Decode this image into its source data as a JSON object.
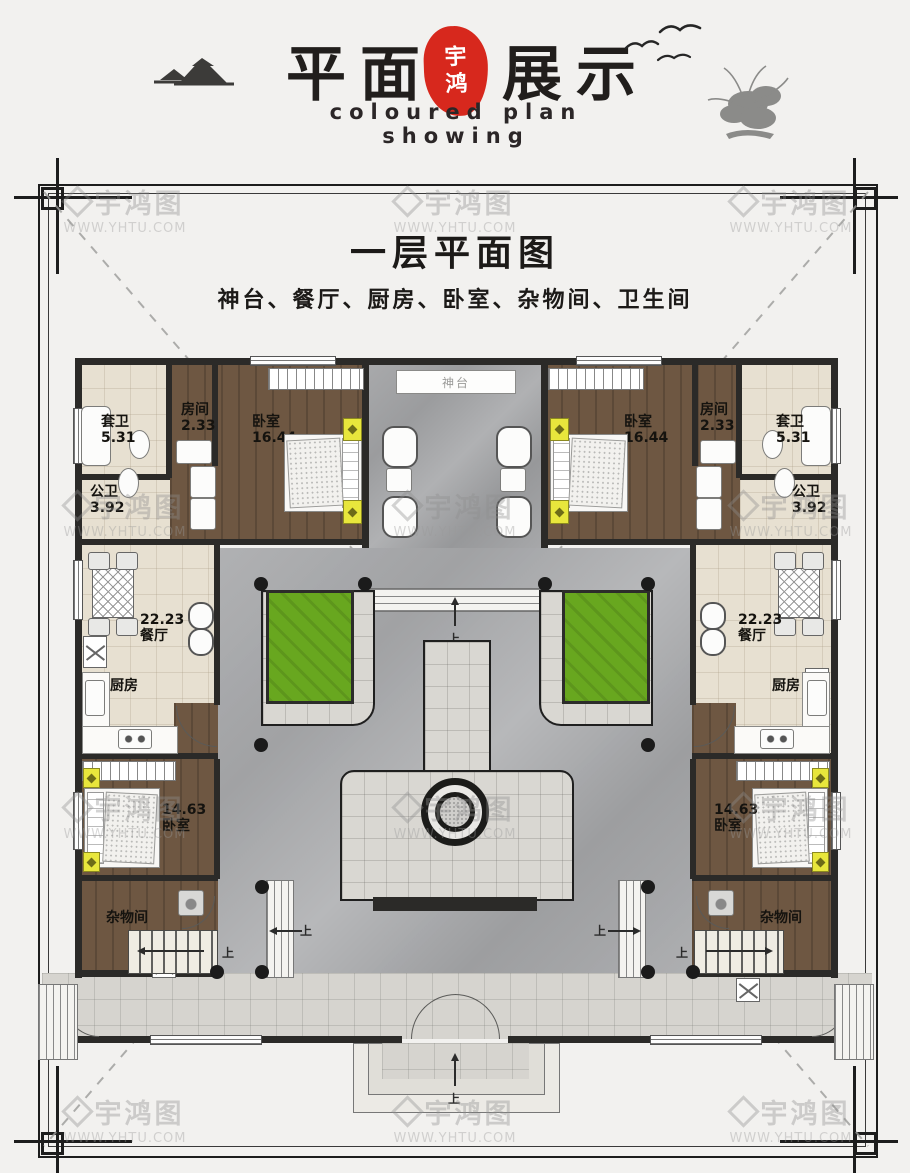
{
  "header": {
    "title_part1": "平面",
    "title_part2": "展示",
    "seal": {
      "char1": "宇",
      "char2": "鸿"
    },
    "subtitle": "coloured plan showing"
  },
  "page": {
    "title": "一层平面图",
    "subtitle": "神台、餐厅、厨房、卧室、杂物间、卫生间"
  },
  "rooms": {
    "altar": "神台",
    "ensuite": {
      "name": "套卫",
      "area": "5.31"
    },
    "small_room": {
      "name": "房间",
      "area": "2.33"
    },
    "bedroom_front": {
      "name": "卧室",
      "area": "16.44"
    },
    "public_bath": {
      "name": "公卫",
      "area": "3.92"
    },
    "dining": {
      "name": "餐厅",
      "area": "22.23"
    },
    "kitchen": {
      "name": "厨房"
    },
    "bedroom_rear": {
      "name": "卧室",
      "area": "14.63"
    },
    "storage": {
      "name": "杂物间"
    }
  },
  "annotations": {
    "up": "上"
  },
  "watermark": {
    "brand": "宇鸿图",
    "url": "WWW.YHTU.COM"
  },
  "colors": {
    "seal_red": "#d7281d",
    "grass_green": "#68a71f",
    "wood_brown": "#6e5742",
    "wall_black": "#2b2a28",
    "beige_tile": "#e7e0d1",
    "marble_gray": "#a3a4a6",
    "cabinet_yellow": "#e8e63c"
  }
}
